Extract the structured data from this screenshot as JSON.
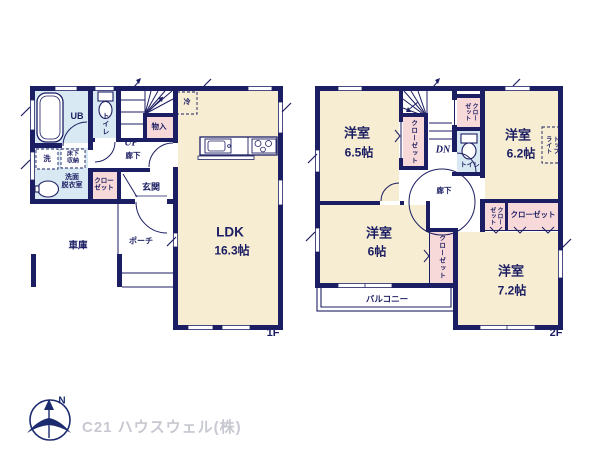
{
  "floor1": {
    "floor_label": "1F",
    "ldk_name": "LDK",
    "ldk_size": "16.3帖",
    "ub": "UB",
    "toilet": "トイレ",
    "storage_small": "物入",
    "up": "UP",
    "hallway": "廊下",
    "fridge": "冷",
    "washer": "洗",
    "underfloor_1": "床下",
    "underfloor_2": "収納",
    "washroom_1": "洗面",
    "washroom_2": "脱衣室",
    "closet_1": "クロー",
    "closet_2": "ゼット",
    "entrance": "玄関",
    "garage": "車庫",
    "porch": "ポーチ"
  },
  "floor2": {
    "floor_label": "2F",
    "room1_name": "洋室",
    "room1_size": "6.5帖",
    "room2_name": "洋室",
    "room2_size": "6.2帖",
    "room3_name": "洋室",
    "room3_size": "6帖",
    "room4_name": "洋室",
    "room4_size": "7.2帖",
    "dn": "DN",
    "hallway": "廊下",
    "toilet": "トイレ",
    "closet_a": "クローゼット",
    "closet_b_1": "クロー",
    "closet_b_2": "ゼット",
    "closet_c_1": "クロー",
    "closet_c_2": "ゼット",
    "closet_d": "クローゼット",
    "closet_e": "クローゼット",
    "toplight_1": "トップ",
    "toplight_2": "ライト",
    "balcony": "バルコニー"
  },
  "footer": {
    "north": "N",
    "company": "C21 ハウスウェル(株)"
  },
  "colors": {
    "wall": "#1c1e63",
    "room_beige": "#f6edd2",
    "wet_blue": "#d9e9f4",
    "storage_pink": "#f8d9d9",
    "brand_gray": "#c8c8d2"
  }
}
